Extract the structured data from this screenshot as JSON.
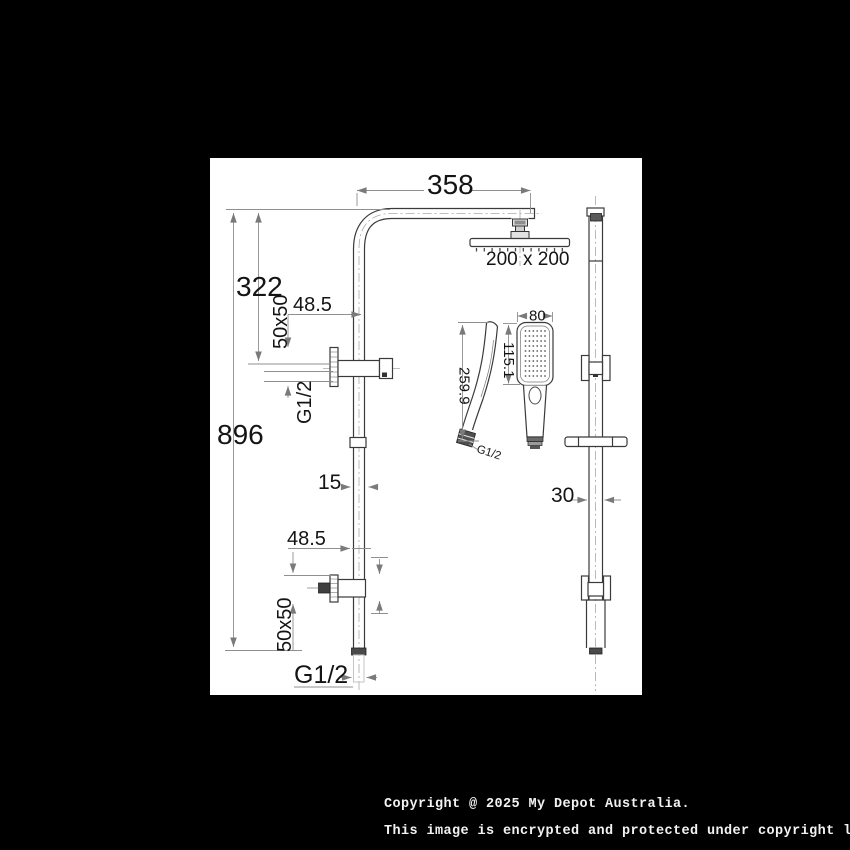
{
  "drawing": {
    "main_view": {
      "arm_length": "358",
      "head_size": "200 x 200",
      "drop_height": "322",
      "total_height": "896",
      "upper_offset": "48.5",
      "upper_flange": "50x50",
      "upper_thread": "G1/2",
      "pipe_width": "15",
      "lower_offset": "48.5",
      "lower_flange": "50x50",
      "inlet_thread": "G1/2"
    },
    "hand_shower": {
      "overall_length": "259.9",
      "head_width": "80",
      "face_height": "115.1",
      "thread": "G1/2"
    },
    "slide_rail": {
      "rail_width": "30"
    }
  },
  "footer": {
    "line1": "Copyright @ 2025 My Depot Australia.",
    "line2": "This image is encrypted and protected under copyright law."
  },
  "colors": {
    "background": "#000000",
    "panel": "#ffffff",
    "object_line": "#3a3a3a",
    "dimension_line": "#8f8f8f",
    "text": "#141414",
    "footer_text": "#f2f2f2"
  }
}
